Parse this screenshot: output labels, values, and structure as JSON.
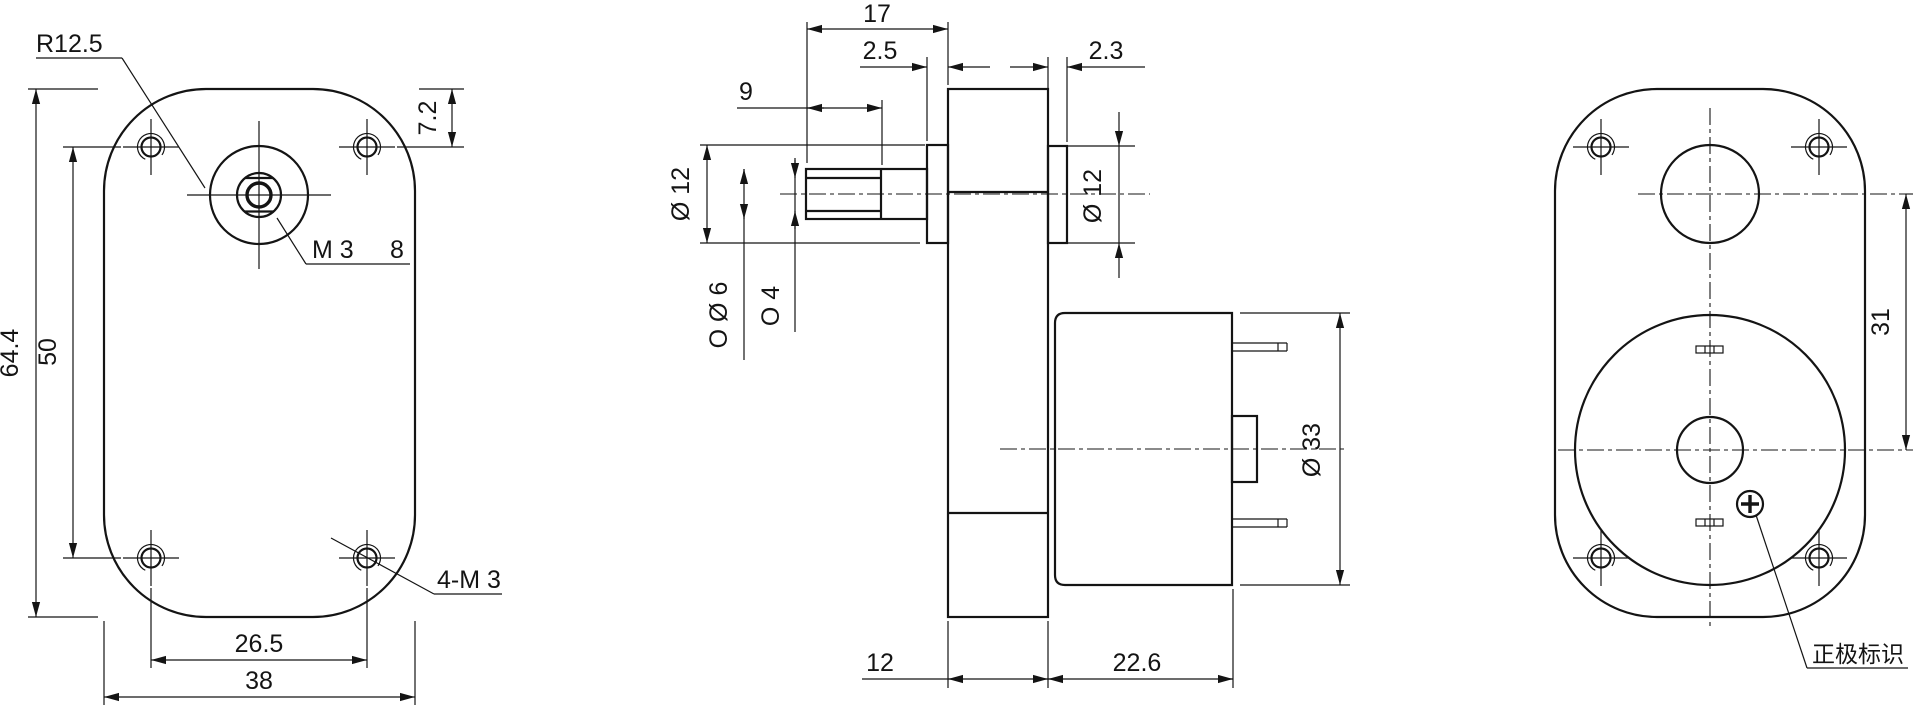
{
  "front_view": {
    "corner_radius_label": "R12.5",
    "tap_label": "M 3",
    "tap_depth_label": "8",
    "mount_label": "4-M 3",
    "dim_edge_to_holes": "7.2",
    "dim_height": "64.4",
    "dim_hole_pitch_v": "50",
    "dim_hole_pitch_h": "26.5",
    "dim_width": "38"
  },
  "side_view": {
    "dim_shaft_total": "17",
    "dim_front_boss": "2.5",
    "dim_flat_length": "9",
    "dim_rear_boss": "2.3",
    "dim_front_boss_dia": "Ø 12",
    "dim_shaft_dia": "O Ø 6",
    "dim_shaft_flat": "O 4",
    "dim_rear_boss_dia": "Ø 12",
    "dim_motor_dia": "Ø 33",
    "dim_body_thickness": "12",
    "dim_motor_length": "22.6"
  },
  "back_view": {
    "dim_axis_distance": "31",
    "polarity_label": "正极标识"
  }
}
